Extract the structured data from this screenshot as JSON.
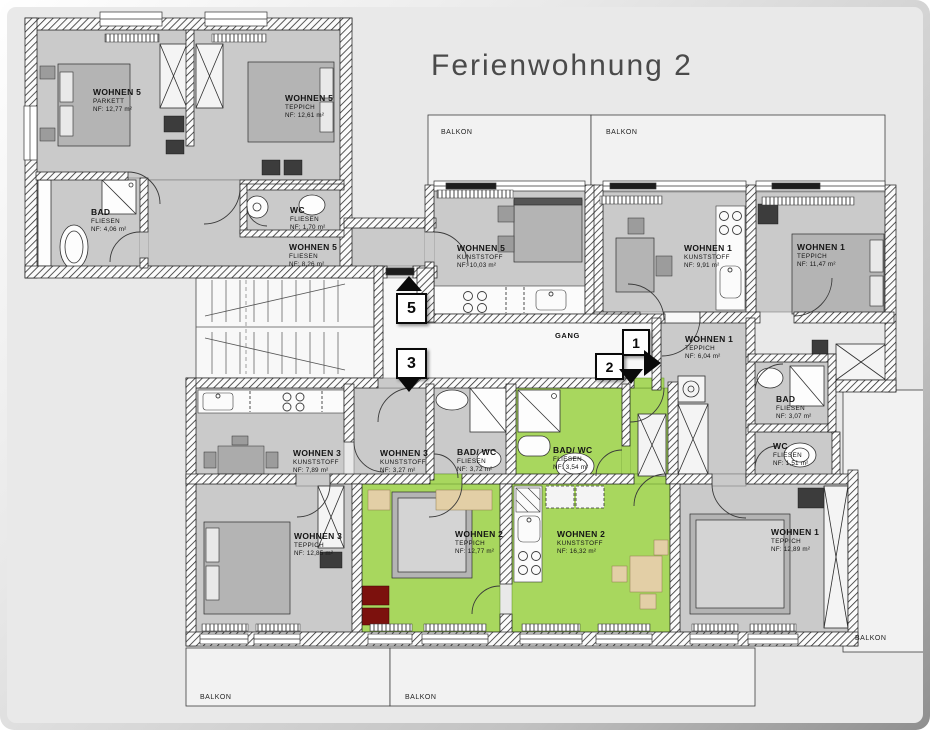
{
  "title": "Ferienwohnung 2",
  "colors": {
    "page_background": "#e9e9e9",
    "room_grey": "#cacaca",
    "highlight_green": "#a8d75e",
    "wall_black": "#1b1b1b",
    "accent_dark_red": "#7c110d"
  },
  "corridor_label": "GANG",
  "rooms": [
    {
      "name": "WOHNEN 5",
      "floor": "PARKETT",
      "area": "NF: 12,77 m²"
    },
    {
      "name": "WOHNEN 5",
      "floor": "TEPPICH",
      "area": "NF: 12,61 m²"
    },
    {
      "name": "BAD",
      "floor": "FLIESEN",
      "area": "NF: 4,06 m²"
    },
    {
      "name": "WC",
      "floor": "FLIESEN",
      "area": "NF: 1,70 m²"
    },
    {
      "name": "WOHNEN 5",
      "floor": "FLIESEN",
      "area": "NF: 8,26 m²"
    },
    {
      "name": "WOHNEN 5",
      "floor": "KUNSTSTOFF",
      "area": "NF: 10,03 m²"
    },
    {
      "name": "WOHNEN 1",
      "floor": "KUNSTSTOFF",
      "area": "NF: 9,91 m²"
    },
    {
      "name": "WOHNEN 1",
      "floor": "TEPPICH",
      "area": "NF: 11,47 m²"
    },
    {
      "name": "WOHNEN 1",
      "floor": "TEPPICH",
      "area": "NF: 6,04 m²"
    },
    {
      "name": "BAD",
      "floor": "FLIESEN",
      "area": "NF: 3,07 m²"
    },
    {
      "name": "WC",
      "floor": "FLIESEN",
      "area": "NF: 1,51 m²"
    },
    {
      "name": "WOHNEN 3",
      "floor": "KUNSTSTOFF",
      "area": "NF: 7,89 m²"
    },
    {
      "name": "WOHNEN 3",
      "floor": "KUNSTSTOFF",
      "area": "NF: 3,27 m²"
    },
    {
      "name": "BAD/ WC",
      "floor": "FLIESEN",
      "area": "NF: 3,72 m²"
    },
    {
      "name": "BAD/ WC",
      "floor": "FLIESEN",
      "area": "NF: 3,54 m²"
    },
    {
      "name": "WOHNEN 3",
      "floor": "TEPPICH",
      "area": "NF: 12,85 m²"
    },
    {
      "name": "WOHNEN 2",
      "floor": "TEPPICH",
      "area": "NF: 12,77 m²"
    },
    {
      "name": "WOHNEN 2",
      "floor": "KUNSTSTOFF",
      "area": "NF: 16,32 m²"
    },
    {
      "name": "WOHNEN 1",
      "floor": "TEPPICH",
      "area": "NF: 12,89 m²"
    }
  ],
  "balconies": {
    "top_left": "BALKON",
    "top_right": "BALKON",
    "bottom_left": "BALKON",
    "bottom_center": "BALKON",
    "right": "BALKON"
  },
  "markers": [
    {
      "label": "5",
      "direction": "up"
    },
    {
      "label": "3",
      "direction": "down"
    },
    {
      "label": "1",
      "direction": "right"
    },
    {
      "label": "2",
      "direction": "down"
    }
  ]
}
